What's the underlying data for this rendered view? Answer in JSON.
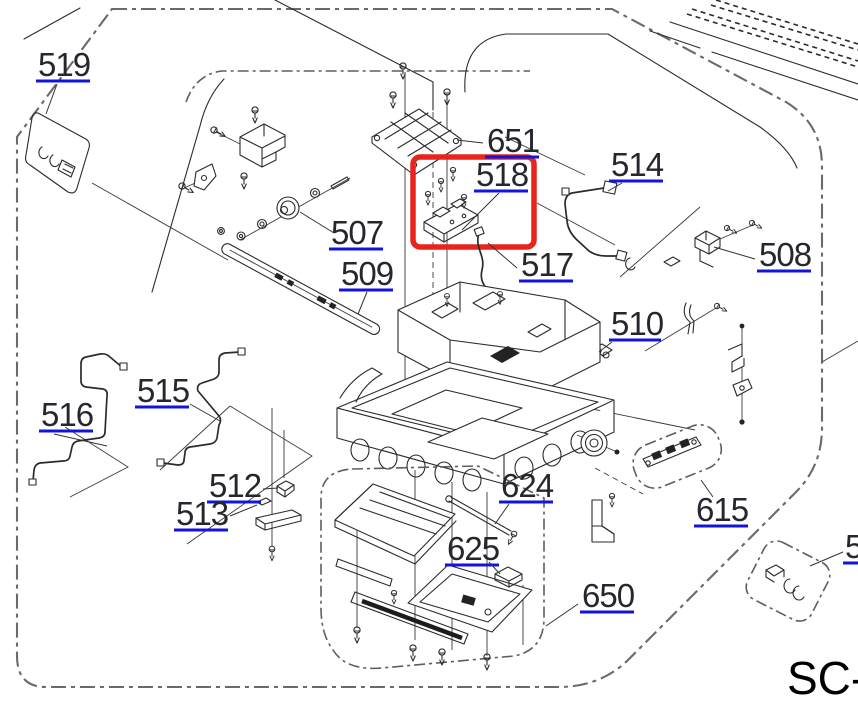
{
  "diagram": {
    "type": "exploded-parts-diagram",
    "highlighted_part": "518",
    "labels": {
      "p519": "519",
      "p651": "651",
      "p514": "514",
      "p507": "507",
      "p509": "509",
      "p518": "518",
      "p517": "517",
      "p508": "508",
      "p510": "510",
      "p515": "515",
      "p516": "516",
      "p512": "512",
      "p513": "513",
      "p624": "624",
      "p625": "625",
      "p650": "650",
      "p615": "615",
      "p_partial_right": "5"
    },
    "footer_model_prefix": "SC-",
    "colors": {
      "highlight_box": "#e8251c",
      "link_underline": "#1313dd",
      "label_text": "#26262e",
      "line_art": "#2b2b2b",
      "boundary": "#6a6a6a"
    }
  }
}
